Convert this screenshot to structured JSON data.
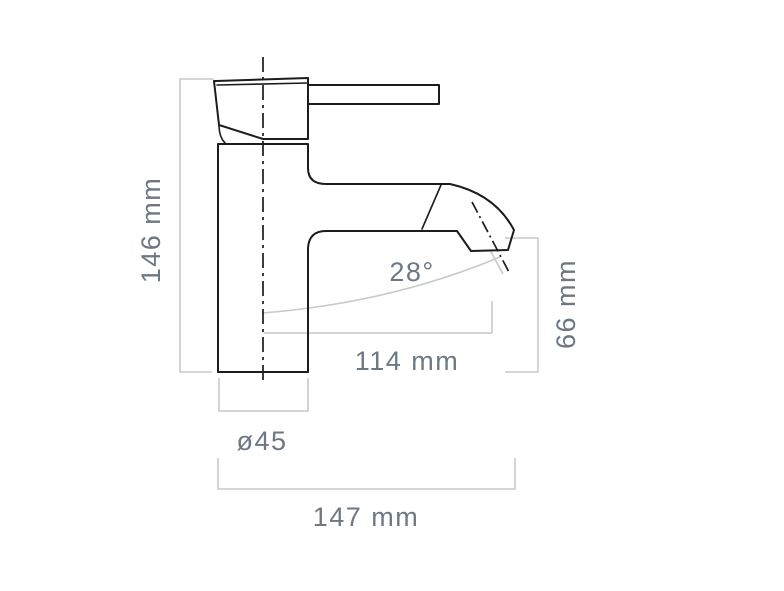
{
  "diagram": {
    "kind": "technical-dimension-drawing",
    "subject": "single-lever basin mixer tap, side profile view",
    "colors": {
      "background": "#ffffff",
      "outline": "#1c1c1c",
      "dimension_lines": "#c9c9c9",
      "dimension_text": "#6d7885"
    },
    "dimensions": {
      "total_height": "146 mm",
      "spout_reach": "114 mm",
      "spout_outlet_height": "66 mm",
      "spout_angle": "28°",
      "base_diameter": "ø45",
      "overall_depth": "147 mm"
    }
  }
}
